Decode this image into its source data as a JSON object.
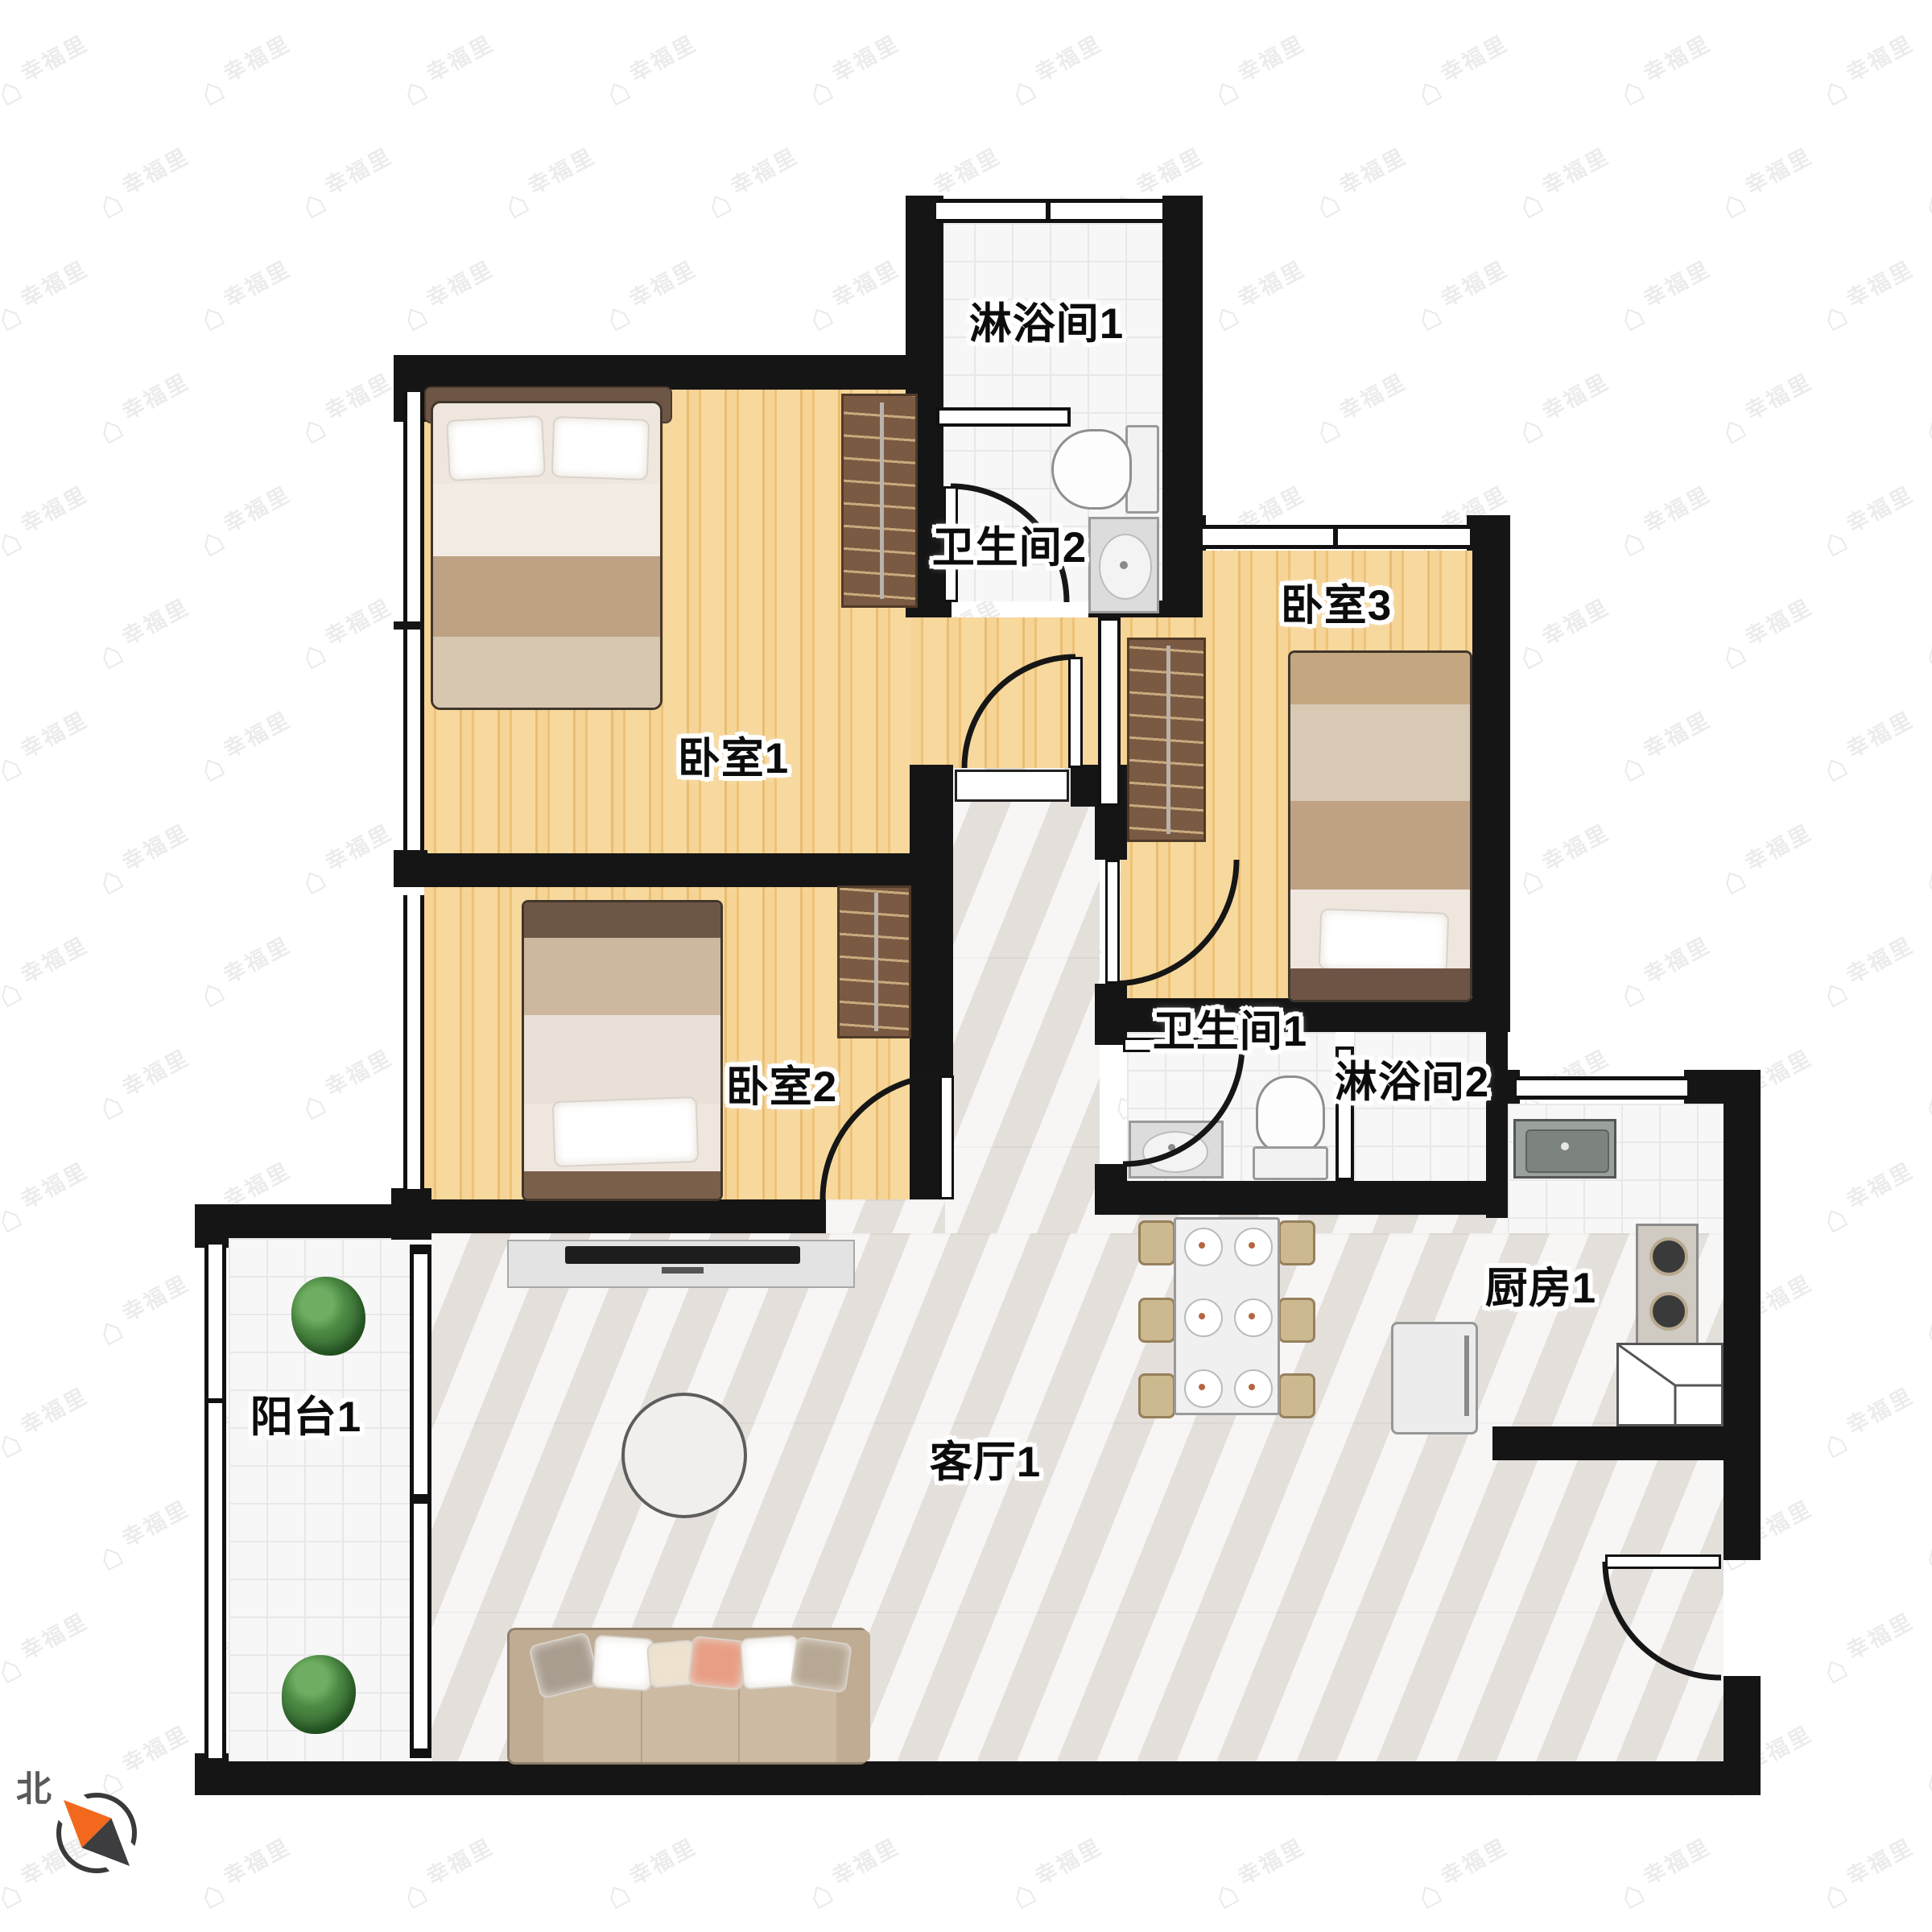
{
  "floor_plan": {
    "type": "apartment-floorplan",
    "rooms": [
      {
        "id": "shower-1",
        "label": "淋浴间1",
        "floor": "tile"
      },
      {
        "id": "bathroom-2",
        "label": "卫生间2",
        "floor": "tile"
      },
      {
        "id": "bedroom-3",
        "label": "卧室3",
        "floor": "wood"
      },
      {
        "id": "bedroom-1",
        "label": "卧室1",
        "floor": "wood"
      },
      {
        "id": "bedroom-2",
        "label": "卧室2",
        "floor": "wood"
      },
      {
        "id": "bathroom-1",
        "label": "卫生间1",
        "floor": "tile"
      },
      {
        "id": "shower-2",
        "label": "淋浴间2",
        "floor": "tile"
      },
      {
        "id": "kitchen-1",
        "label": "厨房1",
        "floor": "tile"
      },
      {
        "id": "living-room-1",
        "label": "客厅1",
        "floor": "marble"
      },
      {
        "id": "balcony-1",
        "label": "阳台1",
        "floor": "tile"
      }
    ],
    "furniture": {
      "bedroom-1": [
        "double-bed",
        "wardrobe"
      ],
      "bedroom-2": [
        "single-bed",
        "wardrobe"
      ],
      "bedroom-3": [
        "single-bed",
        "wardrobe"
      ],
      "bathroom-2": [
        "toilet",
        "sink"
      ],
      "bathroom-1": [
        "toilet",
        "sink"
      ],
      "kitchen-1": [
        "kitchen-sink",
        "gas-stove",
        "corner-counter"
      ],
      "living-room-1": [
        "sofa",
        "tv-stand",
        "round-rug",
        "dining-table",
        "dining-chairs-x6",
        "refrigerator"
      ],
      "balcony-1": [
        "plant",
        "plant"
      ]
    },
    "compass": {
      "north_label": "北",
      "needle_direction": "northwest",
      "colors": {
        "north_needle": "#f2691d",
        "south_needle": "#3d3d40",
        "ring": "#3a3a3a",
        "label": "#5a5a5a"
      }
    },
    "watermark": {
      "text": "幸福里",
      "icon": "house-icon",
      "color": "#ececec"
    },
    "colors": {
      "wall": "#151515",
      "wood_floor": "#f3cf8e",
      "tile_floor": "#f7f7f7",
      "marble_floor": "#edeae7",
      "wardrobe": "#7b5a43",
      "bed_blanket": "#bfa284",
      "sofa": "#cdbaa3",
      "accent_orange": "#f2691d"
    }
  }
}
